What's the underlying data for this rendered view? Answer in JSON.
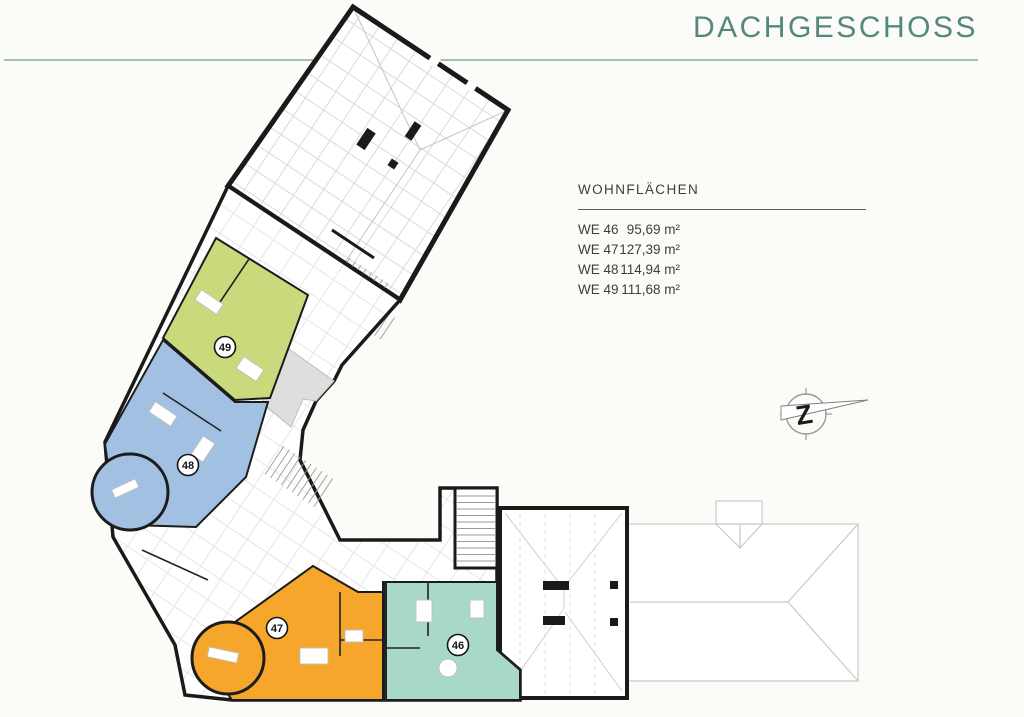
{
  "page": {
    "title": "DACHGESCHOSS"
  },
  "legend": {
    "title": "WOHNFLÄCHEN",
    "rows": [
      {
        "unit": "WE 46",
        "area": "95,69 m²"
      },
      {
        "unit": "WE 47",
        "area": "127,39 m²"
      },
      {
        "unit": "WE 48",
        "area": "114,94 m²"
      },
      {
        "unit": "WE 49",
        "area": "111,68 m²"
      }
    ]
  },
  "plan": {
    "badges": [
      {
        "label": "46"
      },
      {
        "label": "47"
      },
      {
        "label": "48"
      },
      {
        "label": "49"
      }
    ],
    "unit_colors": {
      "we46": "#a7d8ca",
      "we47": "#f6a72b",
      "we48": "#a2c0e2",
      "we49": "#c9da7d"
    }
  },
  "compass": {
    "label": "Z"
  },
  "colors": {
    "accent_teal": "#55887d",
    "rule_teal": "#87a9a1",
    "wall_black": "#1a1a1a",
    "terrace_gray": "#dededd"
  }
}
